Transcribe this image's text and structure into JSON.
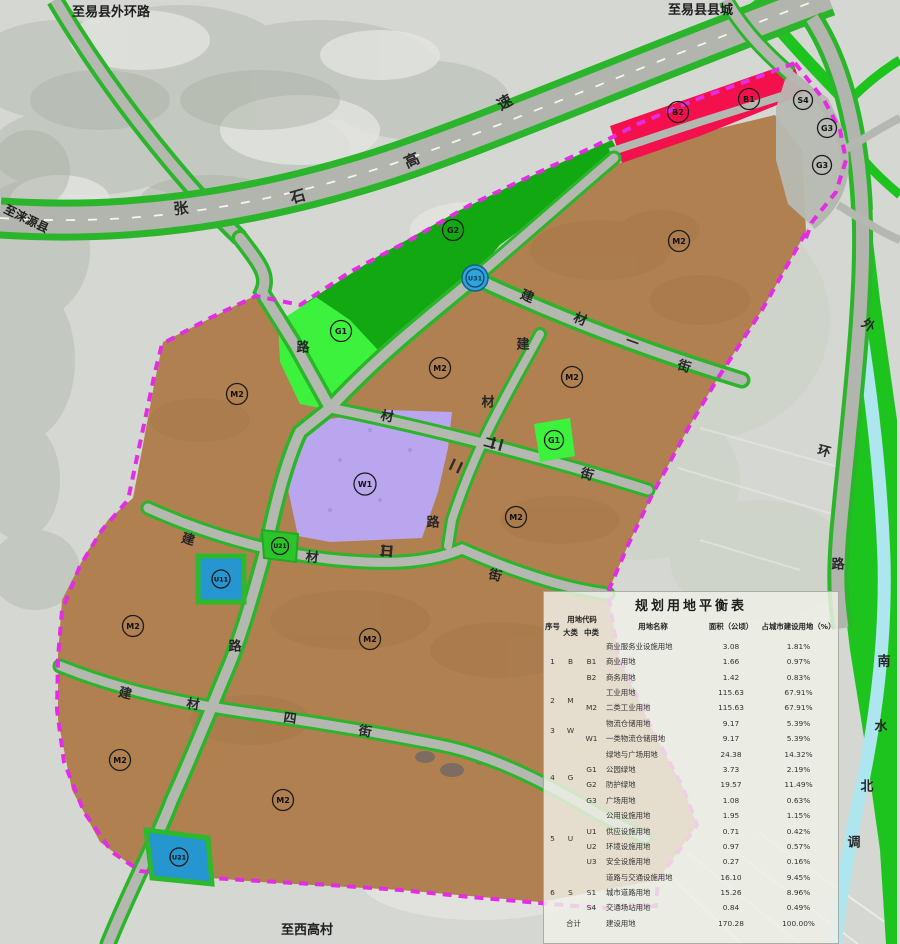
{
  "map": {
    "colors": {
      "industrial_brown": "#b08050",
      "protect_green": "#12a812",
      "park_green": "#3df23d",
      "verge_green": "#2ab52a",
      "band_green": "#1ec41e",
      "commercial_red": "#f4104c",
      "logistics_purple": "#b9a6ee",
      "utility_blue": "#2596cf",
      "boundary_magenta": "#e32ce3",
      "road_gray": "#b5b7b1",
      "canal_blue": "#aee6f0"
    },
    "edge_labels": [
      {
        "id": "to-yixian-outer-ring",
        "text": "至易县外环路",
        "x": 72,
        "y": 16,
        "r": 0,
        "fs": 13
      },
      {
        "id": "to-yixian-county-town",
        "text": "至易县县城",
        "x": 668,
        "y": 14,
        "r": 0,
        "fs": 13
      },
      {
        "id": "to-laiyuan-county",
        "text": "至涞源县",
        "x": 3,
        "y": 212,
        "r": 26,
        "fs": 12
      },
      {
        "id": "to-xigao-village",
        "text": "至西高村",
        "x": 281,
        "y": 934,
        "r": 0,
        "fs": 13
      }
    ],
    "streets": [
      {
        "id": "zhangshi-expressway",
        "name": "张石高速",
        "fs": 15,
        "chars": [
          {
            "c": "张",
            "x": 181,
            "y": 209,
            "r": -6
          },
          {
            "c": "石",
            "x": 298,
            "y": 197,
            "r": -16
          },
          {
            "c": "高",
            "x": 412,
            "y": 161,
            "r": -24
          },
          {
            "c": "速",
            "x": 505,
            "y": 103,
            "r": -30
          }
        ]
      },
      {
        "id": "jiancai-1st-street",
        "name": "建材一街",
        "fs": 13,
        "chars": [
          {
            "c": "建",
            "x": 527,
            "y": 297,
            "r": 23
          },
          {
            "c": "材",
            "x": 580,
            "y": 320,
            "r": 22
          },
          {
            "c": "一",
            "x": 632,
            "y": 343,
            "r": 20
          },
          {
            "c": "街",
            "x": 684,
            "y": 367,
            "r": 18
          }
        ]
      },
      {
        "id": "jiancai-2nd-street",
        "name": "建材二街",
        "fs": 13,
        "chars": [
          {
            "c": "材",
            "x": 387,
            "y": 417,
            "r": 10
          },
          {
            "c": "二",
            "x": 490,
            "y": 444,
            "r": 14
          },
          {
            "c": "街",
            "x": 587,
            "y": 475,
            "r": 16
          }
        ]
      },
      {
        "id": "jiancai-3rd-street",
        "name": "建材三街",
        "fs": 13,
        "chars": [
          {
            "c": "建",
            "x": 188,
            "y": 540,
            "r": 16
          },
          {
            "c": "材",
            "x": 312,
            "y": 558,
            "r": 5
          },
          {
            "c": "三",
            "x": 386,
            "y": 552,
            "r": 3
          },
          {
            "c": "街",
            "x": 495,
            "y": 576,
            "r": 14
          }
        ]
      },
      {
        "id": "jiancai-4th-street",
        "name": "建材四街",
        "fs": 13,
        "chars": [
          {
            "c": "建",
            "x": 125,
            "y": 694,
            "r": 14
          },
          {
            "c": "材",
            "x": 193,
            "y": 705,
            "r": 8
          },
          {
            "c": "四",
            "x": 290,
            "y": 719,
            "r": 8
          },
          {
            "c": "街",
            "x": 365,
            "y": 732,
            "r": 10
          }
        ]
      },
      {
        "id": "jiancai-road",
        "name": "建材路",
        "fs": 13,
        "chars": [
          {
            "c": "建",
            "x": 523,
            "y": 345,
            "r": 0
          },
          {
            "c": "材",
            "x": 488,
            "y": 403,
            "r": 0
          },
          {
            "c": "路",
            "x": 433,
            "y": 523,
            "r": 0
          }
        ]
      },
      {
        "id": "north-south-road",
        "name": "路",
        "fs": 13,
        "chars": [
          {
            "c": "路",
            "x": 303,
            "y": 348,
            "r": 0
          },
          {
            "c": "路",
            "x": 235,
            "y": 647,
            "r": 0
          }
        ]
      },
      {
        "id": "outer-ring-road",
        "name": "外环路",
        "fs": 13,
        "chars": [
          {
            "c": "外",
            "x": 868,
            "y": 326,
            "r": 35
          },
          {
            "c": "环",
            "x": 824,
            "y": 452,
            "r": 15
          },
          {
            "c": "路",
            "x": 838,
            "y": 565,
            "r": 0
          }
        ]
      },
      {
        "id": "south-north-water-canal",
        "name": "南水北调",
        "fs": 13,
        "chars": [
          {
            "c": "南",
            "x": 884,
            "y": 662,
            "r": 0
          },
          {
            "c": "水",
            "x": 881,
            "y": 727,
            "r": 0
          },
          {
            "c": "北",
            "x": 867,
            "y": 787,
            "r": 0
          },
          {
            "c": "调",
            "x": 854,
            "y": 843,
            "r": 0
          }
        ]
      }
    ],
    "zone_labels": [
      {
        "code": "M2",
        "x": 237,
        "y": 394
      },
      {
        "code": "M2",
        "x": 440,
        "y": 368
      },
      {
        "code": "M2",
        "x": 572,
        "y": 377
      },
      {
        "code": "M2",
        "x": 679,
        "y": 241
      },
      {
        "code": "M2",
        "x": 516,
        "y": 517
      },
      {
        "code": "M2",
        "x": 133,
        "y": 626
      },
      {
        "code": "M2",
        "x": 370,
        "y": 639
      },
      {
        "code": "M2",
        "x": 120,
        "y": 760
      },
      {
        "code": "M2",
        "x": 283,
        "y": 800
      },
      {
        "code": "W1",
        "x": 365,
        "y": 484,
        "rad": 11
      },
      {
        "code": "G1",
        "x": 341,
        "y": 331
      },
      {
        "code": "G1",
        "x": 554,
        "y": 440,
        "rad": 9.5
      },
      {
        "code": "G2",
        "x": 453,
        "y": 230
      },
      {
        "code": "B1",
        "x": 749,
        "y": 99
      },
      {
        "code": "B2",
        "x": 678,
        "y": 112
      },
      {
        "code": "S4",
        "x": 803,
        "y": 100,
        "rad": 9.5
      },
      {
        "code": "G3",
        "x": 827,
        "y": 128,
        "rad": 9.5
      },
      {
        "code": "G3",
        "x": 822,
        "y": 165,
        "rad": 9.5
      },
      {
        "code": "U31",
        "x": 475,
        "y": 278,
        "style": "disc",
        "rad": 9,
        "fs": 6.5
      },
      {
        "code": "U11",
        "x": 221,
        "y": 579,
        "rad": 9,
        "fs": 6.5
      },
      {
        "code": "U21",
        "x": 179,
        "y": 857,
        "rad": 9,
        "fs": 6.5
      },
      {
        "code": "U21",
        "x": 280,
        "y": 546,
        "rad": 8.5,
        "fs": 6
      }
    ]
  },
  "table": {
    "title": "规划用地平衡表",
    "headers": {
      "no": "序号",
      "code": "用地代码",
      "major": "大类",
      "mid": "中类",
      "name": "用地名称",
      "area": "面积（公顷）",
      "pct": "占城市建设用地（%）"
    },
    "rows": [
      {
        "no": "1",
        "span": 3,
        "major": "B",
        "mid": "",
        "name": "商业服务业设施用地",
        "area": "3.08",
        "pct": "1.81%"
      },
      {
        "mid": "B1",
        "name": "商业用地",
        "area": "1.66",
        "pct": "0.97%"
      },
      {
        "mid": "B2",
        "name": "商务用地",
        "area": "1.42",
        "pct": "0.83%"
      },
      {
        "no": "2",
        "span": 2,
        "major": "M",
        "mid": "",
        "name": "工业用地",
        "area": "115.63",
        "pct": "67.91%"
      },
      {
        "mid": "M2",
        "name": "二类工业用地",
        "area": "115.63",
        "pct": "67.91%"
      },
      {
        "no": "3",
        "span": 2,
        "major": "W",
        "mid": "",
        "name": "物流仓储用地",
        "area": "9.17",
        "pct": "5.39%"
      },
      {
        "mid": "W1",
        "name": "一类物流仓储用地",
        "area": "9.17",
        "pct": "5.39%"
      },
      {
        "no": "4",
        "span": 4,
        "major": "G",
        "mid": "",
        "name": "绿地与广场用地",
        "area": "24.38",
        "pct": "14.32%"
      },
      {
        "mid": "G1",
        "name": "公园绿地",
        "area": "3.73",
        "pct": "2.19%"
      },
      {
        "mid": "G2",
        "name": "防护绿地",
        "area": "19.57",
        "pct": "11.49%"
      },
      {
        "mid": "G3",
        "name": "广场用地",
        "area": "1.08",
        "pct": "0.63%"
      },
      {
        "no": "5",
        "span": 4,
        "major": "U",
        "mid": "",
        "name": "公用设施用地",
        "area": "1.95",
        "pct": "1.15%"
      },
      {
        "mid": "U1",
        "name": "供应设施用地",
        "area": "0.71",
        "pct": "0.42%"
      },
      {
        "mid": "U2",
        "name": "环境设施用地",
        "area": "0.97",
        "pct": "0.57%"
      },
      {
        "mid": "U3",
        "name": "安全设施用地",
        "area": "0.27",
        "pct": "0.16%"
      },
      {
        "no": "6",
        "span": 3,
        "major": "S",
        "mid": "",
        "name": "道路与交通设施用地",
        "area": "16.10",
        "pct": "9.45%"
      },
      {
        "mid": "S1",
        "name": "城市道路用地",
        "area": "15.26",
        "pct": "8.96%"
      },
      {
        "mid": "S4",
        "name": "交通场站用地",
        "area": "0.84",
        "pct": "0.49%"
      },
      {
        "total": true,
        "no": "合计",
        "name": "建设用地",
        "area": "170.28",
        "pct": "100.00%"
      }
    ]
  }
}
